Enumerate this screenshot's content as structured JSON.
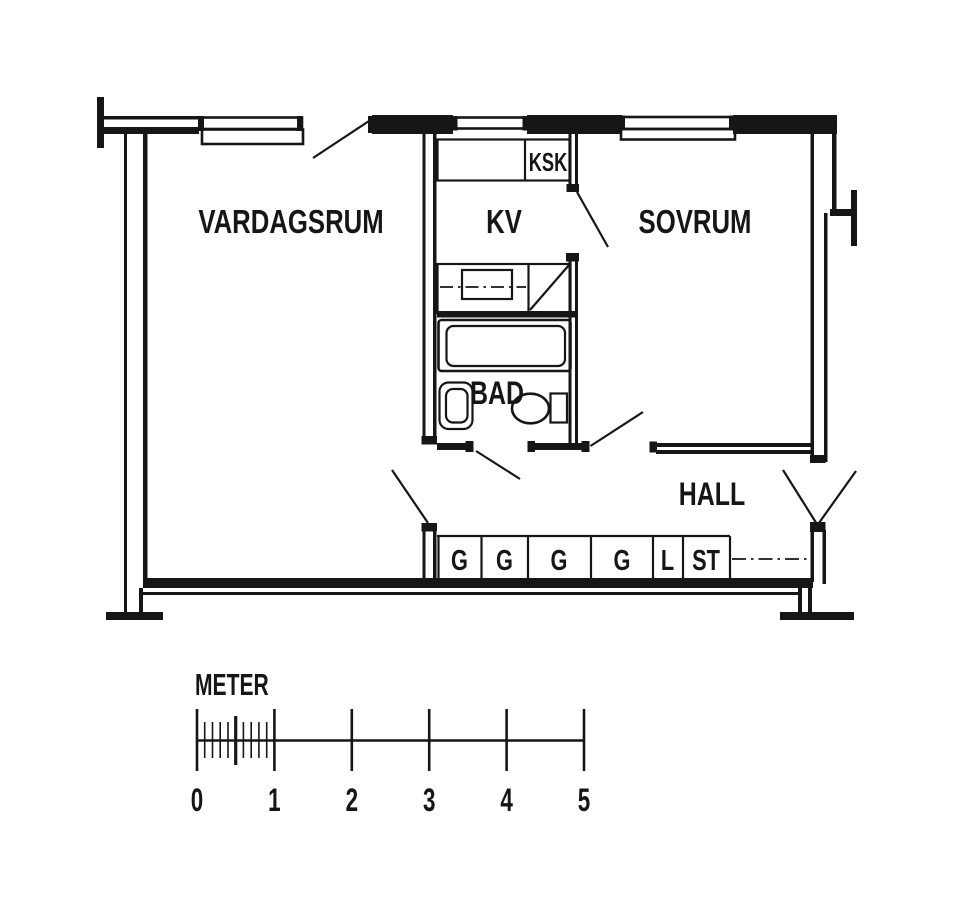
{
  "rooms": {
    "vardagsrum": "VARDAGSRUM",
    "kv": "KV",
    "sovrum": "SOVRUM",
    "bad": "BAD",
    "hall": "HALL"
  },
  "kitchen": {
    "ksk": "KSK"
  },
  "closets": [
    "G",
    "G",
    "G",
    "G",
    "L",
    "ST"
  ],
  "scale_bar": {
    "label": "METER",
    "ticks": [
      "0",
      "1",
      "2",
      "3",
      "4",
      "5"
    ]
  },
  "colors": {
    "ink": "#161616",
    "paper": "#ffffff"
  }
}
